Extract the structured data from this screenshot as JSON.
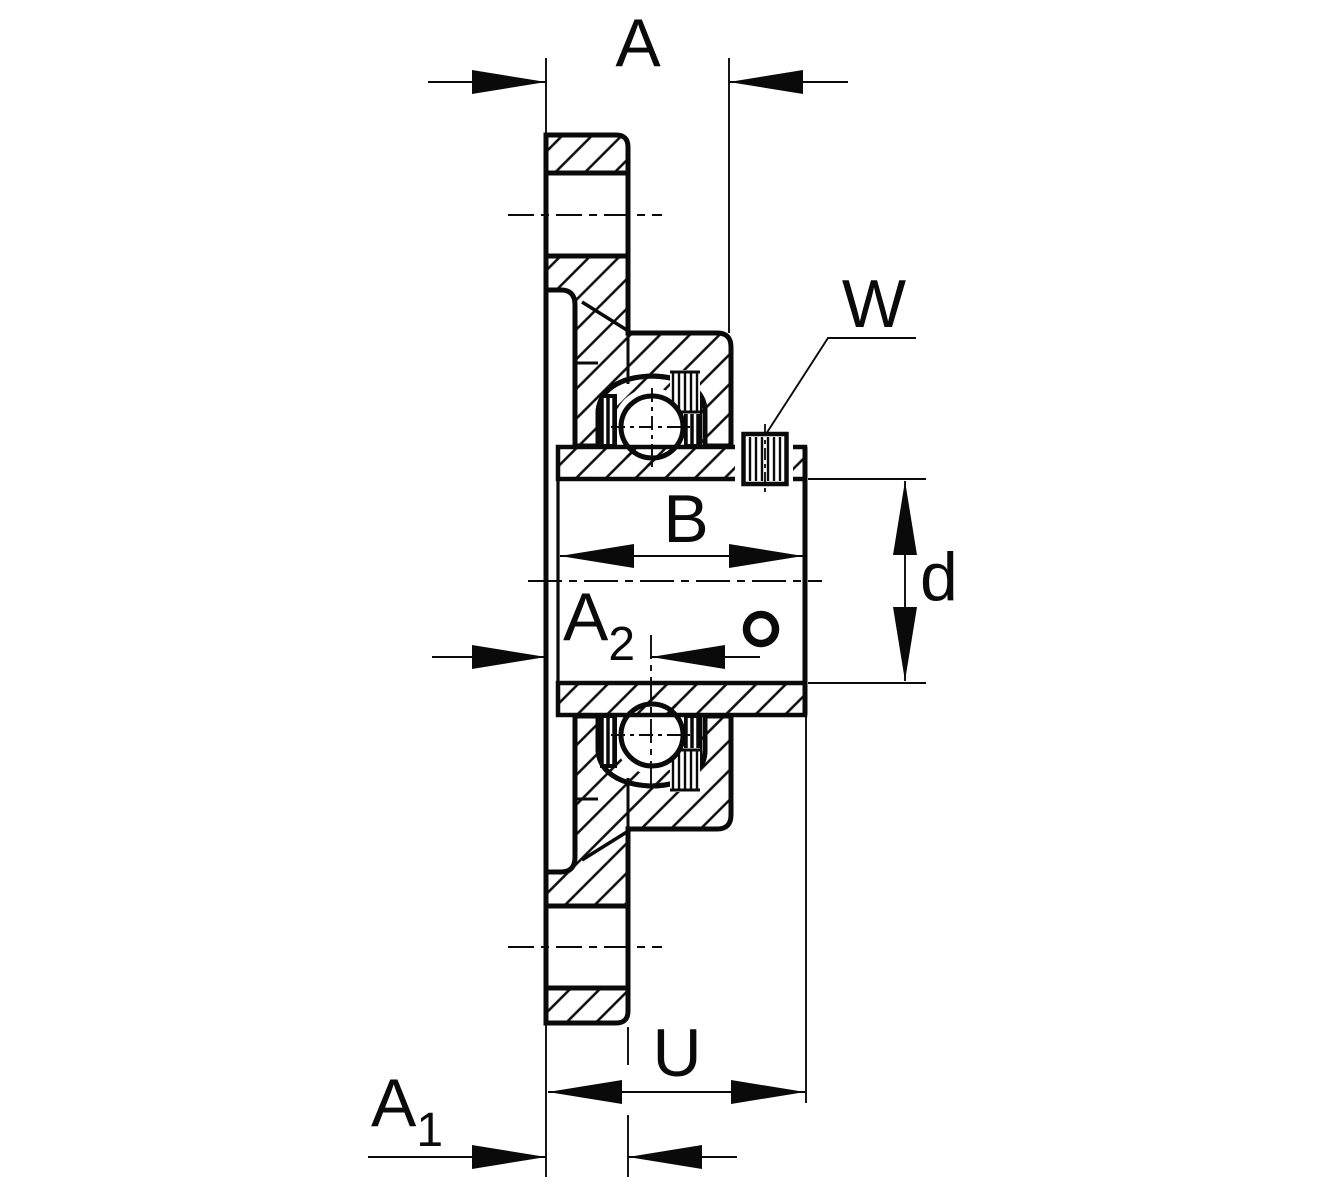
{
  "drawing": {
    "kind": "sectional technical drawing",
    "subject": "flanged bearing housing unit with set screws",
    "background": "#ffffff",
    "line_color": "#0a0a0a",
    "labels": {
      "A": "A",
      "W": "W",
      "B": "B",
      "d": "d",
      "A2_base": "A",
      "A2_sub": "2",
      "U": "U",
      "A1_base": "A",
      "A1_sub": "1"
    }
  }
}
